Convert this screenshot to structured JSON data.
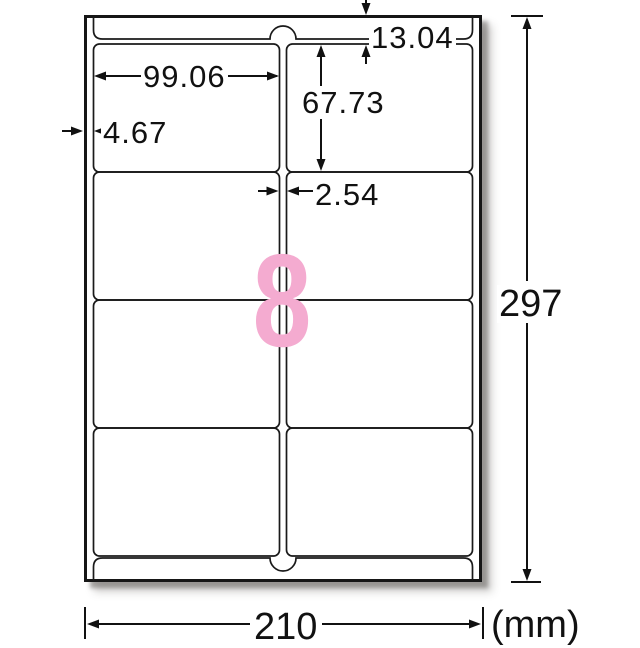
{
  "diagram": {
    "type": "label-sheet-dimension-diagram",
    "sheet": {
      "width_mm": "210",
      "height_mm": "297",
      "unit": "(mm)"
    },
    "labels": {
      "count": "8",
      "columns": 2,
      "rows": 4,
      "width_mm": "99.06",
      "height_mm": "67.73"
    },
    "margins": {
      "top_mm": "13.04",
      "side_mm": "4.67",
      "column_gap_mm": "2.54"
    },
    "colors": {
      "count_pink": "#f4abd0",
      "line": "#1a1a1a",
      "paper": "#ffffff"
    }
  }
}
